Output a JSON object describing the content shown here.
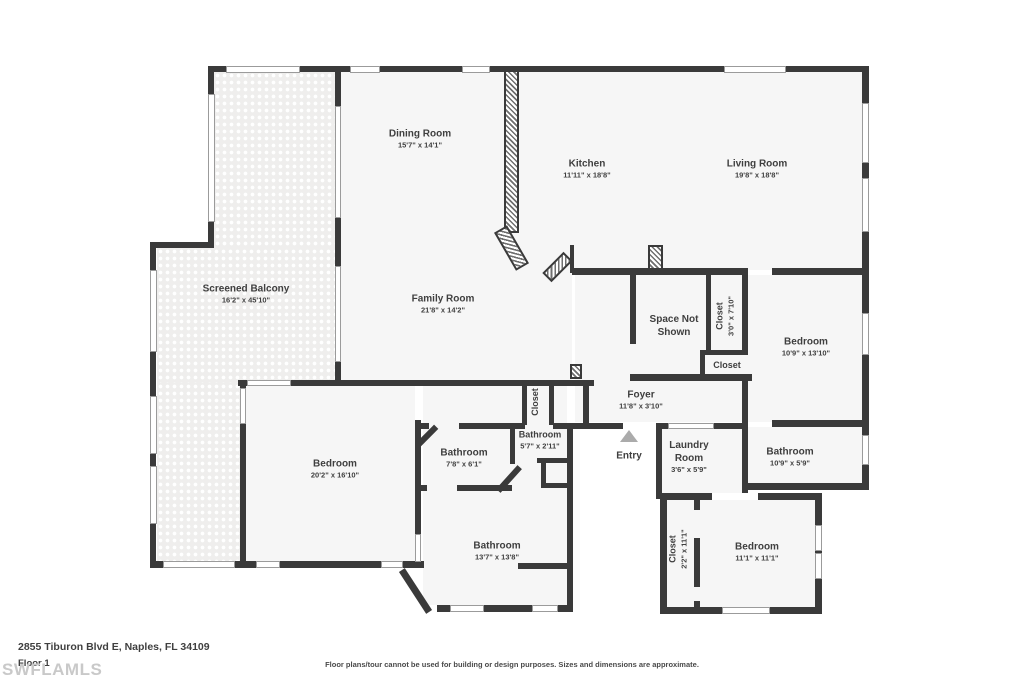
{
  "footer": {
    "address": "2855 Tiburon Blvd E, Naples, FL 34109",
    "floor": "Floor 1",
    "watermark": "SWFLAMLS",
    "disclaimer": "Floor plans/tour cannot be used for building or design purposes. Sizes and dimensions are approximate."
  },
  "entry_label": "Entry",
  "rooms": [
    {
      "name": "Dining Room",
      "dims": "15'7\" x 14'1\""
    },
    {
      "name": "Kitchen",
      "dims": "11'11\" x 18'8\""
    },
    {
      "name": "Living Room",
      "dims": "19'8\" x 18'8\""
    },
    {
      "name": "Screened Balcony",
      "dims": "16'2\" x 45'10\""
    },
    {
      "name": "Family Room",
      "dims": "21'8\" x 14'2\""
    },
    {
      "name": "Space Not Shown",
      "dims": ""
    },
    {
      "name": "Closet",
      "dims": "3'0\" x 7'10\""
    },
    {
      "name": "Bedroom",
      "dims": "10'9\" x 13'10\""
    },
    {
      "name": "Closet",
      "dims": ""
    },
    {
      "name": "Foyer",
      "dims": "11'8\" x 3'10\""
    },
    {
      "name": "Bedroom",
      "dims": "20'2\" x 16'10\""
    },
    {
      "name": "Closet",
      "dims": ""
    },
    {
      "name": "Bathroom",
      "dims": "7'8\" x 6'1\""
    },
    {
      "name": "Bathroom",
      "dims": "5'7\" x 2'11\""
    },
    {
      "name": "Laundry Room",
      "dims": "3'6\" x 5'9\""
    },
    {
      "name": "Bathroom",
      "dims": "10'9\" x 5'9\""
    },
    {
      "name": "Bathroom",
      "dims": "13'7\" x 13'8\""
    },
    {
      "name": "Closet",
      "dims": "2'2\" x 11'1\""
    },
    {
      "name": "Bedroom",
      "dims": "11'1\" x 11'1\""
    }
  ]
}
